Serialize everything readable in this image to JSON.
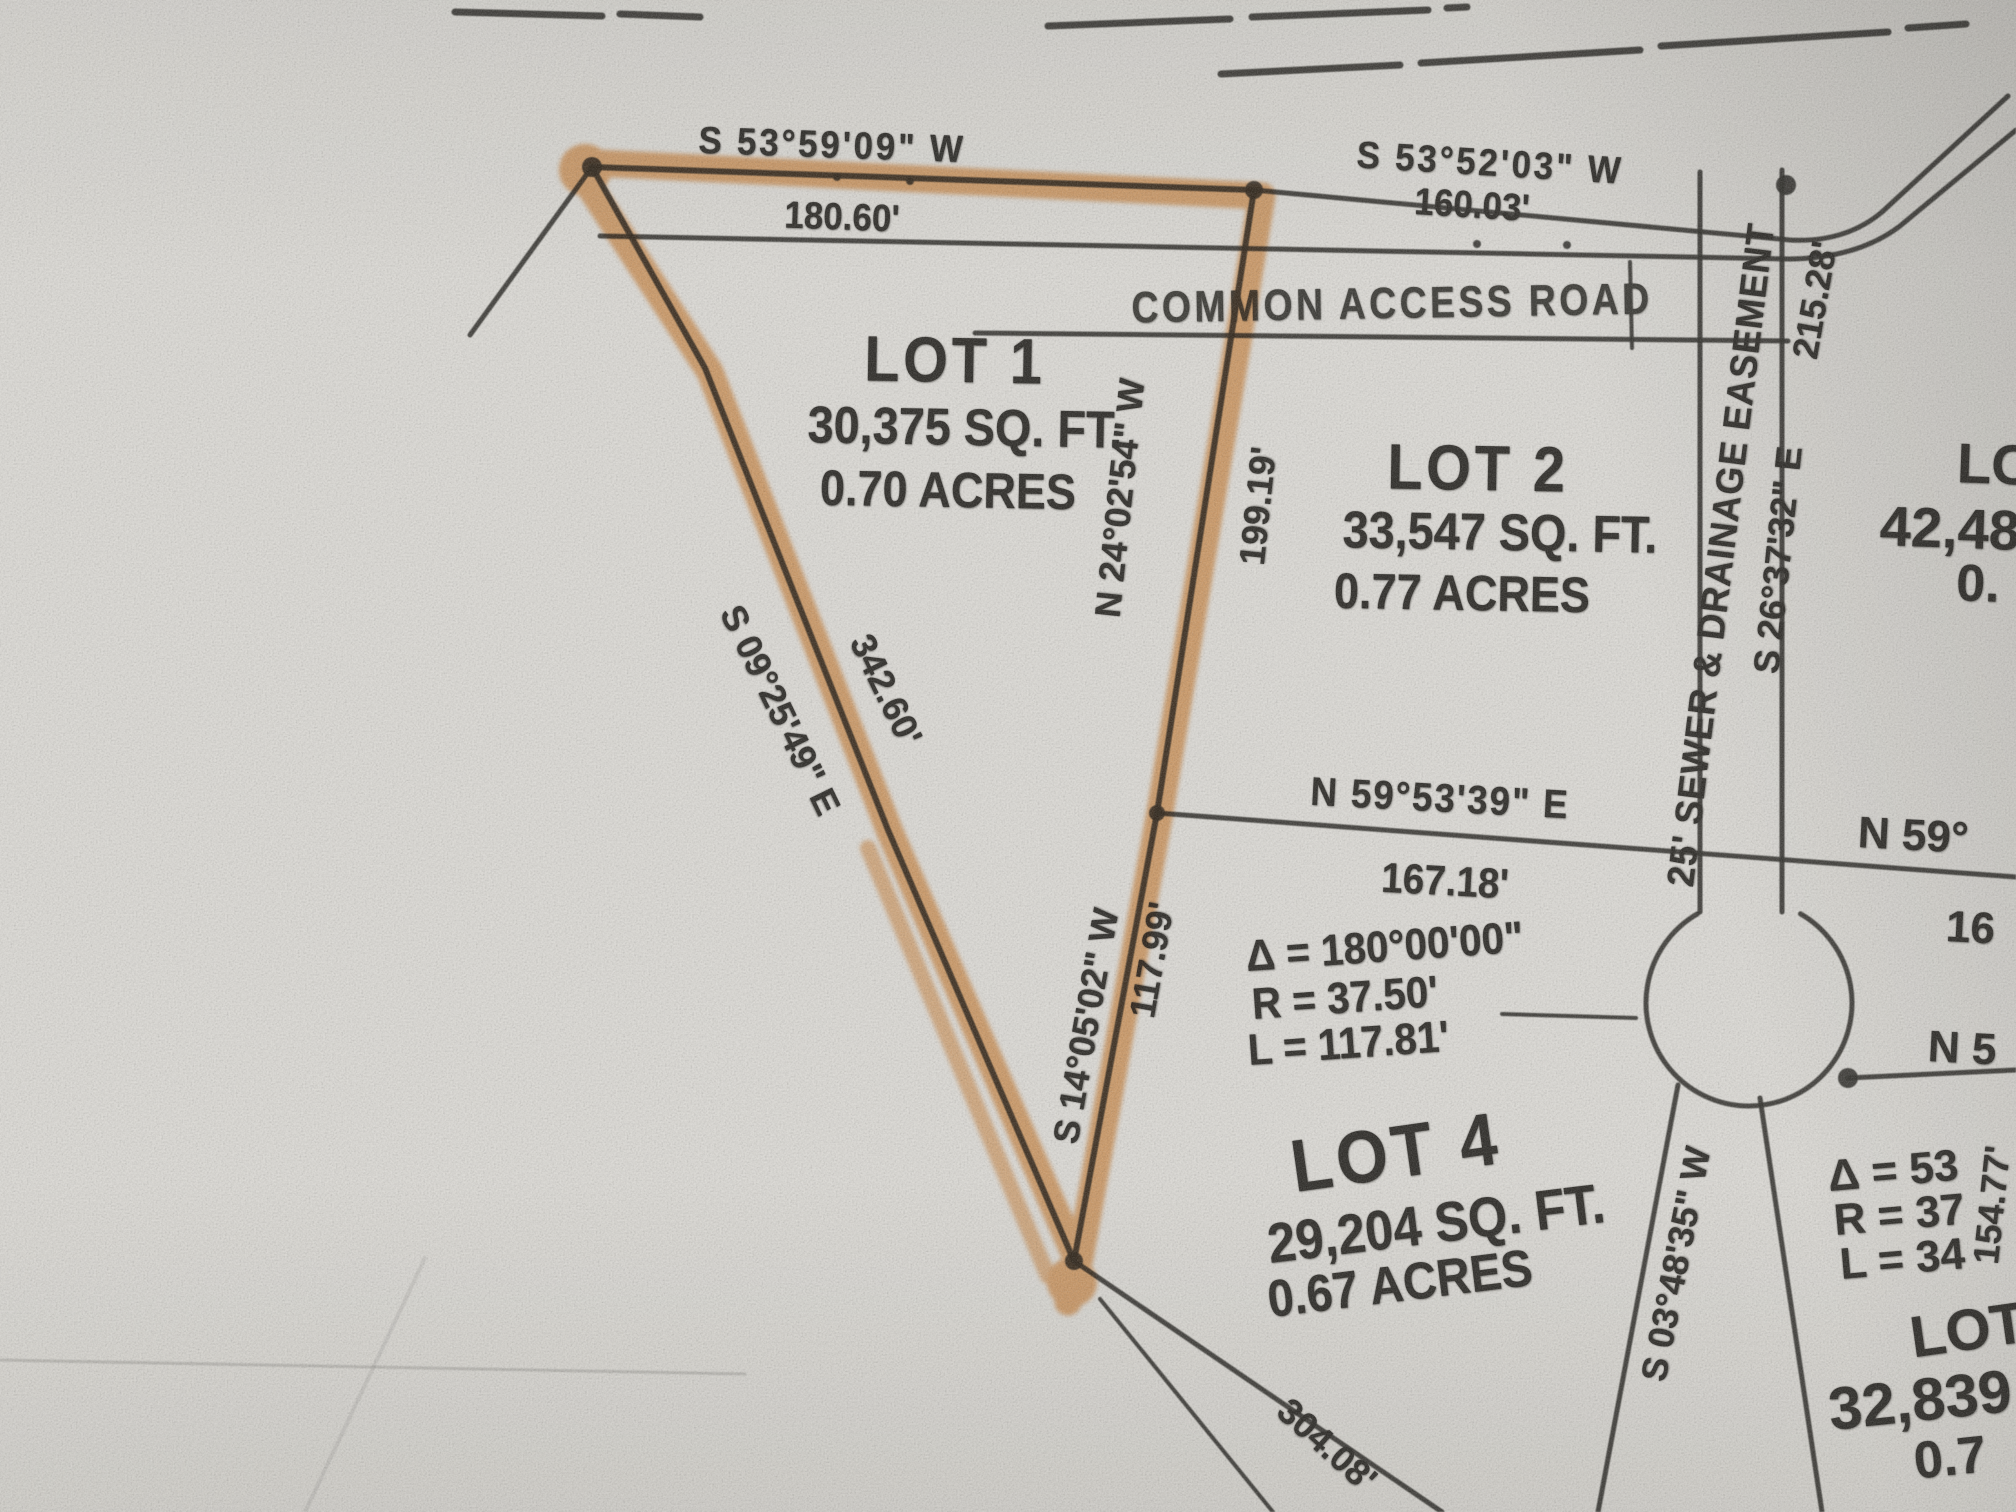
{
  "colors": {
    "paper": "#dcdad5",
    "ink": "#262420",
    "highlight": "#e2882f"
  },
  "road": {
    "name": "COMMON ACCESS ROAD"
  },
  "lots": {
    "lot1": {
      "name": "LOT 1",
      "sqft": "30,375 SQ. FT.",
      "acres": "0.70 ACRES"
    },
    "lot2": {
      "name": "LOT 2",
      "sqft": "33,547 SQ. FT.",
      "acres": "0.77 ACRES"
    },
    "lot4": {
      "name": "LOT 4",
      "sqft": "29,204 SQ. FT.",
      "acres": "0.67 ACRES"
    },
    "lot3_partial": {
      "name": "LO",
      "sqft": "42,48",
      "acres": "0."
    },
    "lot_br_partial": {
      "name": "LOT",
      "sqft": "32,839",
      "acres": "0.7"
    }
  },
  "courses": {
    "north_road_west": {
      "bearing": "S 53°59'09\" W",
      "distance": "180.60'"
    },
    "north_road_east": {
      "bearing": "S 53°52'03\" W",
      "distance": "160.03'"
    },
    "lot1_south": {
      "bearing": "N 59°53'39\" E",
      "distance": "167.18'"
    },
    "lot1_west": {
      "bearing": "S 09°25'49\" E",
      "distance": "342.60'"
    },
    "lot1_east_upper": {
      "bearing": "N 24°02'54\" W",
      "distance": "199.19'"
    },
    "lot1_east_lower": {
      "bearing": "S 14°05'02\" W",
      "distance": "117.99'"
    },
    "easement": {
      "bearing": "S 26°37'32\" E",
      "distance": "215.28'"
    },
    "far_right": {
      "bearing": "S 03°48'35\" W",
      "distance": "154.77'"
    },
    "bottom": {
      "distance": "304.08'"
    }
  },
  "curves": {
    "lot1_culdesac": {
      "delta": "Δ = 180°00'00\"",
      "radius": "R = 37.50'",
      "arc": "L = 117.81'"
    },
    "right_partial": {
      "delta": "Δ = 53",
      "radius": "R = 37",
      "arc": "L = 34"
    }
  },
  "easement_label": "25' SEWER & DRAINAGE EASEMENT",
  "partial_texts": {
    "n59": "N 59°",
    "d16": "16",
    "n5": "N 5"
  }
}
